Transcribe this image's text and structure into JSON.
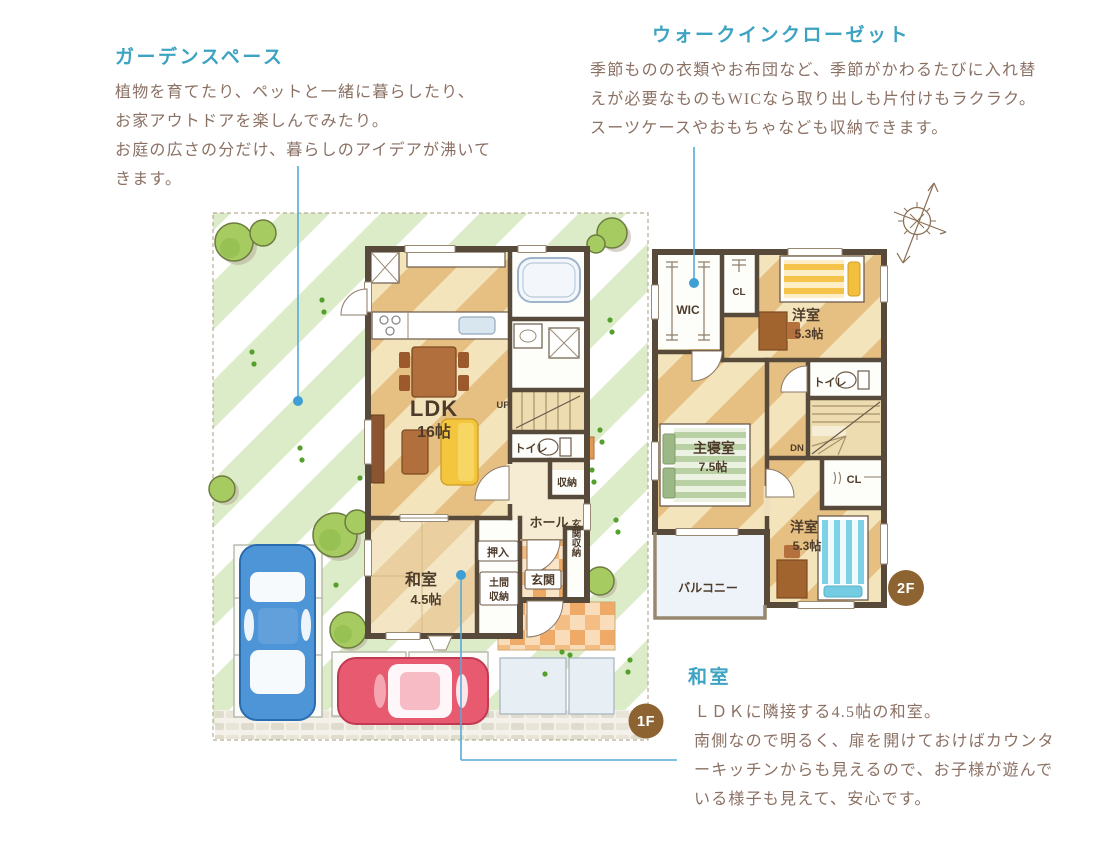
{
  "colors": {
    "accent_teal": "#3da3c2",
    "body_text": "#8b7164",
    "callout_line": "#57aad9",
    "wall": "#584a3b",
    "badge_brown": "#8d6332",
    "car_blue": "#4e95d8",
    "car_red": "#e85a70"
  },
  "annotations": {
    "garden": {
      "title": "ガーデンスペース",
      "lines": [
        "植物を育てたり、ペットと一緒に暮らしたり、",
        "お家アウトドアを楽しんでみたり。",
        "お庭の広さの分だけ、暮らしのアイデアが沸いて",
        "きます。"
      ]
    },
    "wic": {
      "title": "ウォークインクローゼット",
      "lines": [
        "季節ものの衣類やお布団など、季節がかわるたびに入れ替",
        "えが必要なものもWICなら取り出しも片付けもラクラク。",
        "スーツケースやおもちゃなども収納できます。"
      ]
    },
    "washitsu": {
      "title": "和室",
      "lines": [
        "ＬＤＫに隣接する4.5帖の和室。",
        "南側なので明るく、扉を開けておけばカウンタ",
        "ーキッチンからも見えるので、お子様が遊んで",
        "いる様子も見えて、安心です。"
      ]
    }
  },
  "floor1": {
    "badge": "1F",
    "labels": {
      "ldk": "LDK",
      "ldk_size": "16帖",
      "washitsu": "和室",
      "washitsu_size": "4.5帖",
      "oshiire": "押入",
      "doma1": "土間",
      "doma2": "収納",
      "genkan": "玄関",
      "genkan_shuno": "玄関収納",
      "hall": "ホール",
      "shuno": "収納",
      "toilet": "トイレ",
      "up": "UP"
    }
  },
  "floor2": {
    "badge": "2F",
    "labels": {
      "wic": "WIC",
      "cl_top": "CL",
      "yoshitsu1": "洋室",
      "yoshitsu1_size": "5.3帖",
      "shinshitsu": "主寝室",
      "shinshitsu_size": "7.5帖",
      "toilet": "トイレ",
      "dn": "DN",
      "cl_right": "CL",
      "yoshitsu2": "洋室",
      "yoshitsu2_size": "5.3帖",
      "balcony": "バルコニー"
    }
  }
}
